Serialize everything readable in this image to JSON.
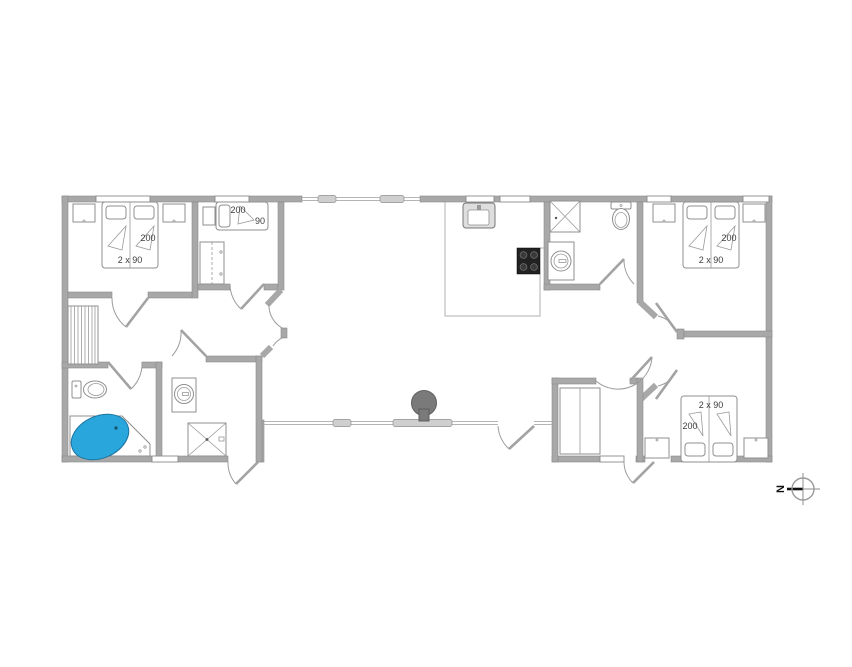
{
  "title": "Holiday house floor plan",
  "colors": {
    "background": "#ffffff",
    "wall_fill": "#a8a8a8",
    "wall_stroke": "#8a8a8a",
    "thin_line": "#b0b0b0",
    "bathtub_fill": "#29a7dc",
    "stove_fill": "#7a7a7a",
    "cooktop_fill": "#222222",
    "label_color": "#3c3c3c"
  },
  "labels": {
    "bed1_length": "200",
    "bed1_size": "2 x 90",
    "bed2_length": "200",
    "bed2_width": "90",
    "bed3_length": "200",
    "bed3_size": "2 x 90",
    "bed4_size": "2 x 90",
    "bed4_length": "200",
    "compass_north": "N"
  },
  "fixtures": [
    "double-bed",
    "single-bed",
    "nightstand",
    "wardrobe",
    "toilet",
    "shower",
    "washbasin",
    "corner-bathtub",
    "kitchen-sink",
    "cooktop",
    "wood-stove",
    "slatted-mat",
    "compass"
  ]
}
